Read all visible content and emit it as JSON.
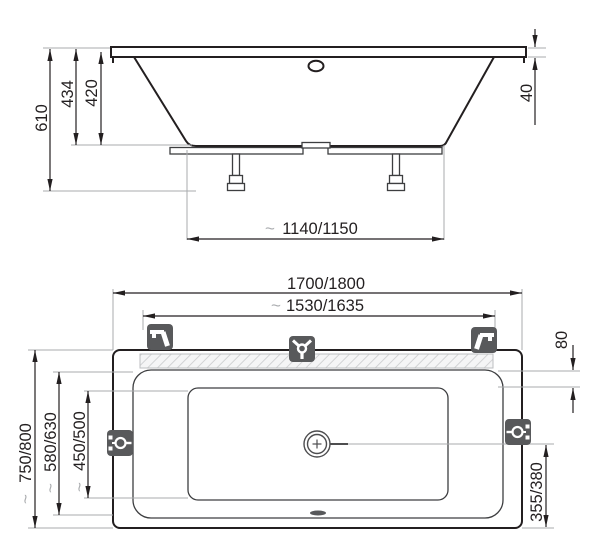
{
  "document": {
    "type": "technical-drawing",
    "subject": "bathtub installation dimensions, side view and top view"
  },
  "approx_symbol": "~",
  "side_view": {
    "name": "bathtub-side-view",
    "dims": {
      "total_height": "610",
      "depth_outer": "434",
      "depth_inner": "420",
      "rim_thickness": "40",
      "feet_span": "1140/1150"
    }
  },
  "top_view": {
    "name": "bathtub-top-view",
    "dims": {
      "length_outer": "1700/1800",
      "length_inner": "1530/1635",
      "apron_width": "80",
      "width_outer": "750/800",
      "width_inner": "580/630",
      "width_bottom": "450/500",
      "drain_offset": "355/380"
    }
  },
  "icons": {
    "top_left": "faucet-icon",
    "top_center": "mixer-tap-icon",
    "top_right": "faucet-icon",
    "side_left": "water-connection-icon",
    "side_right": "water-connection-icon",
    "drain": "drain-icon",
    "overflow": "overflow-icon"
  },
  "colors": {
    "line": "#231f20",
    "extension": "#a9abae",
    "icon_background": "#58595b",
    "hatch": "#d2d3d5"
  }
}
